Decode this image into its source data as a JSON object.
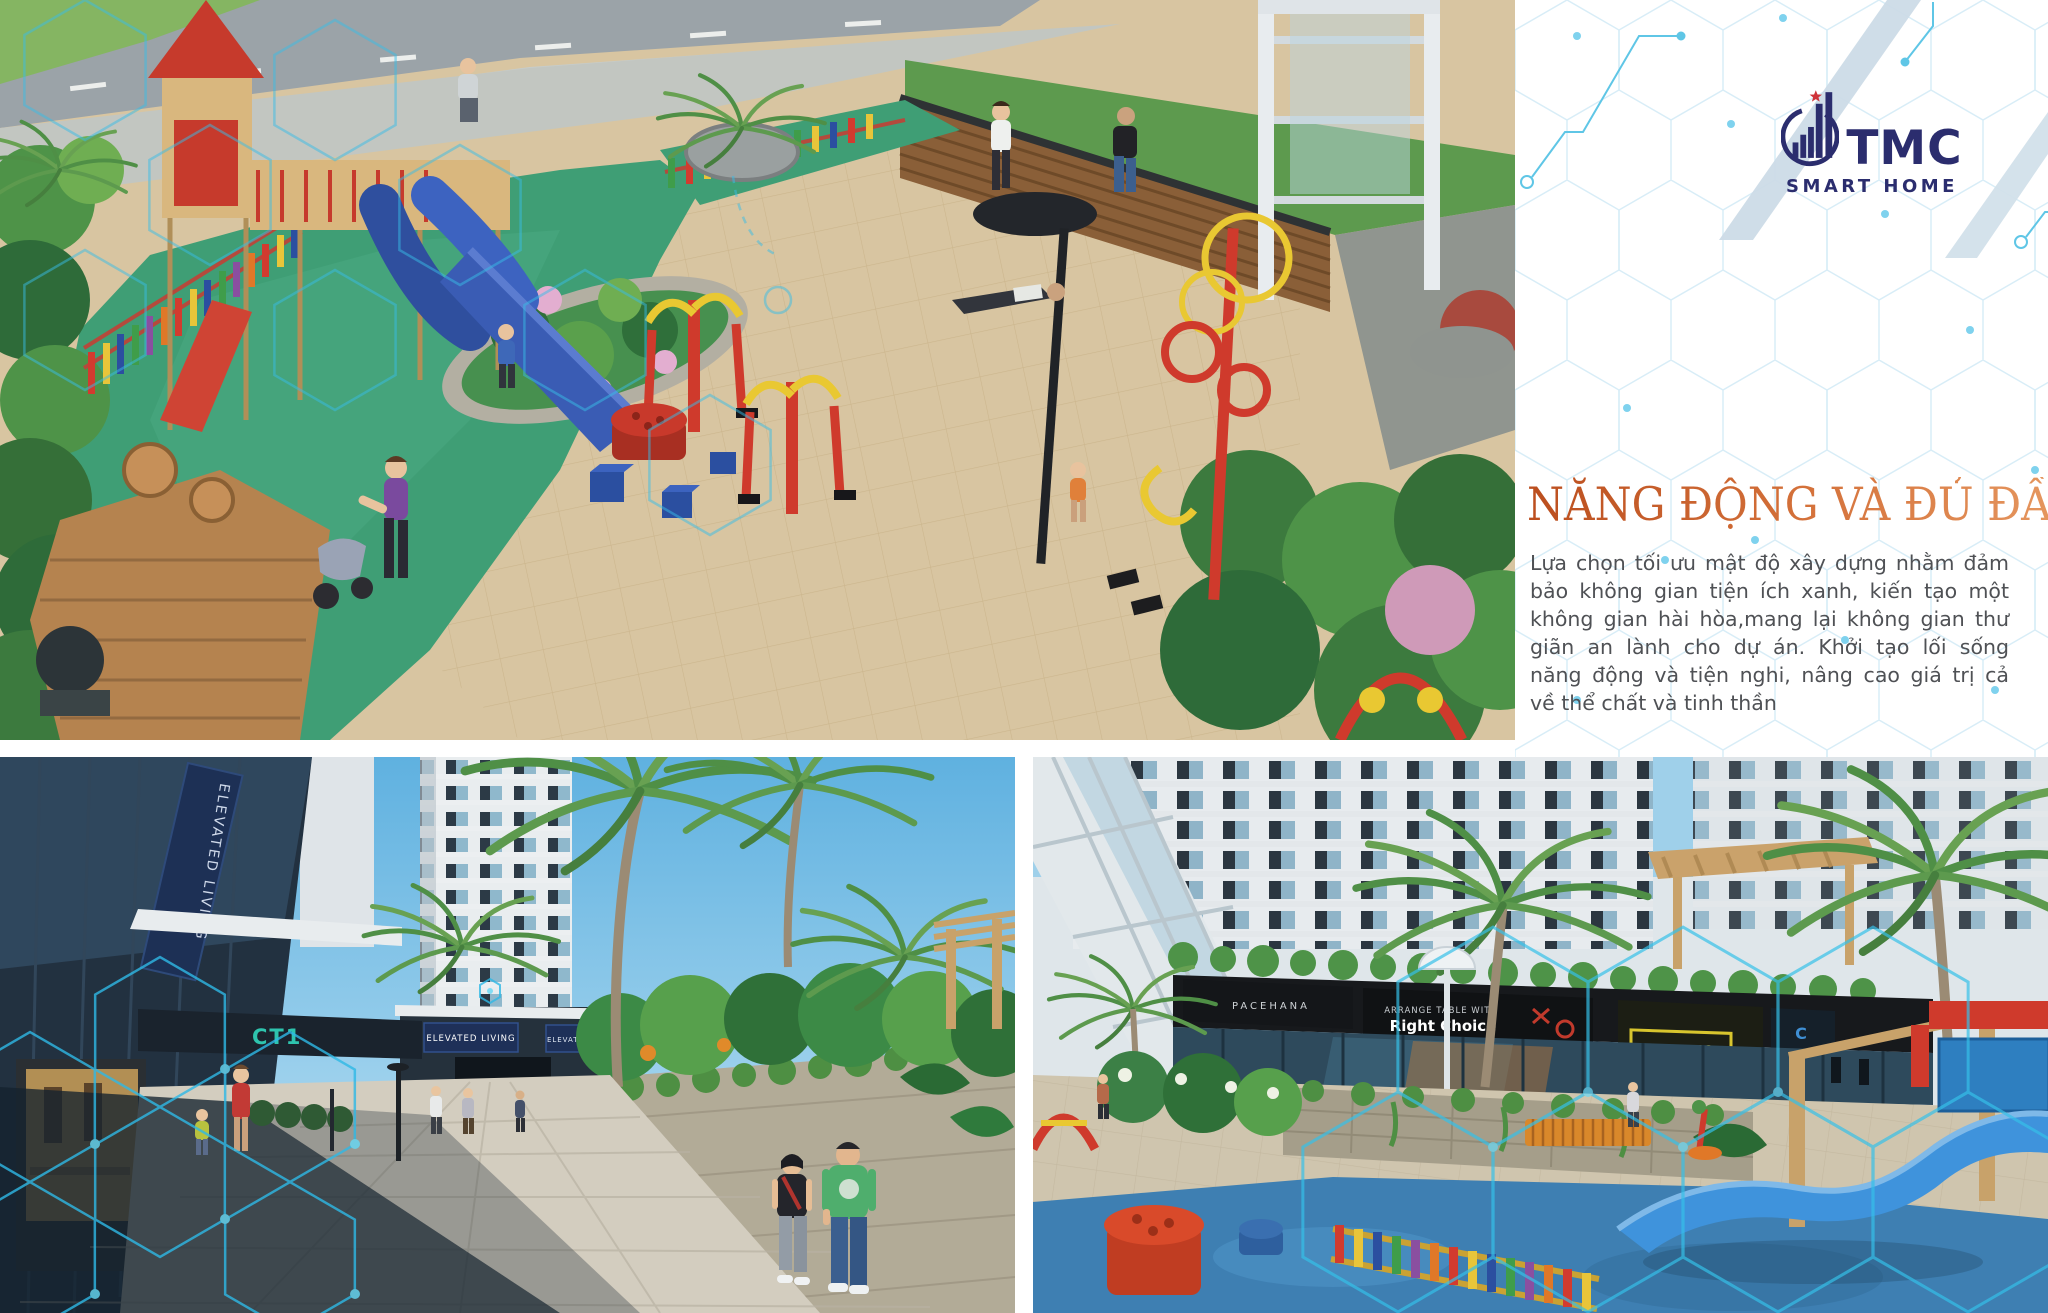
{
  "page": {
    "width": 2048,
    "height": 1313,
    "background": "#ffffff"
  },
  "brand": {
    "name": "TMC",
    "tagline": "SMART HOME",
    "color": "#2b2d6e",
    "star_color": "#cf3339"
  },
  "panel": {
    "heading": "NĂNG ĐỘNG VÀ ĐỦ ĐẦY",
    "heading_gradient_start": "#bb4e1e",
    "heading_gradient_end": "#e79a62",
    "body_lines": [
      "Lựa chọn tối ưu mật độ xây dựng nhằm đảm",
      "bảo không gian tiện ích xanh, kiến tạo một",
      "không gian hài hòa,mang lại không gian thư",
      "giãn an lành cho dự án. Khởi tạo lối sống",
      "năng động và tiện nghi, nâng cao giá trị cả",
      "về thể chất và tinh thần"
    ],
    "hex_line_color": "#d8edf7",
    "hex_dot_color": "#7fd2ee",
    "ribbon_color": "#ccdbe7",
    "circuit_color": "#5fc6e6"
  },
  "photos": {
    "aerial_playground": {
      "hex_overlay_color": "#38bce6"
    },
    "street_view": {
      "banner_text": "ELEVATED LIVING",
      "tower_sign": "CT1"
    },
    "retail_plaza": {
      "sign_tagline": "ARRANGE TABLE WITH",
      "sign_title": "Right Choice",
      "sign_left": "PACEHANA",
      "sign_right": "AXMETO"
    }
  }
}
